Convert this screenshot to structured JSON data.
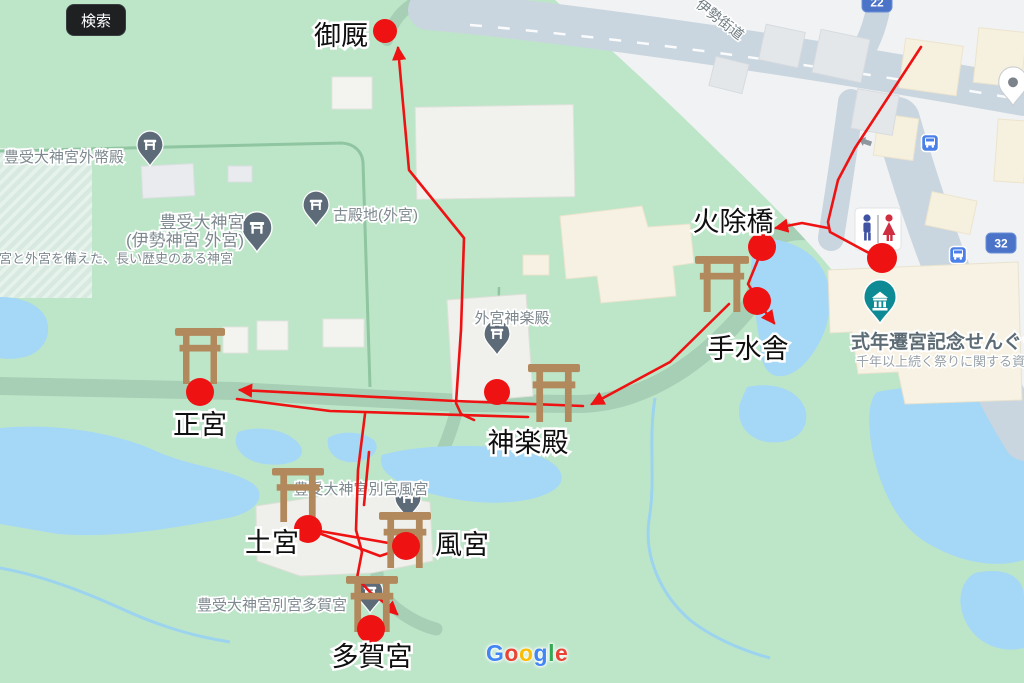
{
  "search_button": {
    "label": "検索"
  },
  "attribution": {
    "brand": "Google",
    "letters": [
      {
        "ch": "G",
        "color": "#4285F4"
      },
      {
        "ch": "o",
        "color": "#EA4335"
      },
      {
        "ch": "o",
        "color": "#FBBC05"
      },
      {
        "ch": "g",
        "color": "#4285F4"
      },
      {
        "ch": "l",
        "color": "#34A853"
      },
      {
        "ch": "e",
        "color": "#EA4335"
      }
    ]
  },
  "colors": {
    "route_red": "#ee1212",
    "torii_brown": "#b2895c",
    "pin_grey": "#5d6b78",
    "museum_teal": "#0d8a93",
    "shield_blue": "#4b74c9",
    "water": "#a5d7f6",
    "park_green": "#bde6c9",
    "road_grey": "#c9d5df"
  },
  "road_shields": [
    {
      "number": "22",
      "x": 877,
      "y": 2
    },
    {
      "number": "32",
      "x": 1001,
      "y": 243
    }
  ],
  "road_names": [
    {
      "text": "伊勢街道",
      "x": 695,
      "y": 6,
      "rotation": 38
    }
  ],
  "poi_labels": [
    {
      "text": "豊受大神宮外幣殿",
      "x": 64,
      "y": 162,
      "cls": ""
    },
    {
      "text": "豊受大神宮",
      "x": 202,
      "y": 228,
      "cls": "big"
    },
    {
      "text": "(伊勢神宮 外宮)",
      "x": 185,
      "y": 246,
      "cls": "big"
    },
    {
      "text": "内宮と外宮を備えた、長い歴史のある神宮",
      "x": -14,
      "y": 263,
      "cls": "small start"
    },
    {
      "text": "古殿地(外宮)",
      "x": 333,
      "y": 220,
      "cls": "start"
    },
    {
      "text": "外宮神楽殿",
      "x": 512,
      "y": 323,
      "cls": ""
    },
    {
      "text": "豊受大神宮別宮風宮",
      "x": 361,
      "y": 494,
      "cls": ""
    },
    {
      "text": "豊受大神宮別宮多賀宮",
      "x": 272,
      "y": 610,
      "cls": ""
    }
  ],
  "museum_label": {
    "title": "式年遷宮記念せんぐう館",
    "title_x": 851,
    "title_y": 348,
    "subtitle": "千年以上続く祭りに関する資",
    "subtitle_x": 856,
    "subtitle_y": 366
  },
  "poi_pins": [
    {
      "type": "shrine",
      "x": 150,
      "y": 152,
      "s": 1
    },
    {
      "type": "shrine",
      "x": 257,
      "y": 236,
      "s": 1.15
    },
    {
      "type": "shrine",
      "x": 316,
      "y": 212,
      "s": 1
    },
    {
      "type": "shrine",
      "x": 497,
      "y": 341,
      "s": 1
    },
    {
      "type": "shrine",
      "x": 408,
      "y": 505,
      "s": 1
    },
    {
      "type": "shrine",
      "x": 370,
      "y": 599,
      "s": 1
    },
    {
      "type": "museum",
      "x": 880,
      "y": 306,
      "s": 1.25
    }
  ],
  "map_icons": {
    "restroom": {
      "x": 878,
      "y": 229
    },
    "generic_pin": {
      "x": 1013,
      "y": 90
    },
    "bus_stops": [
      {
        "x": 930,
        "y": 143
      },
      {
        "x": 958,
        "y": 255
      }
    ]
  },
  "annotations": {
    "dots": [
      {
        "name": "miumaya",
        "x": 385,
        "y": 31,
        "r": 12
      },
      {
        "name": "rest-area",
        "x": 882,
        "y": 258,
        "r": 15
      },
      {
        "name": "hiyokebashi",
        "x": 762,
        "y": 247,
        "r": 14
      },
      {
        "name": "temizusha",
        "x": 757,
        "y": 301,
        "r": 14
      },
      {
        "name": "kaguraden",
        "x": 497,
        "y": 392,
        "r": 13
      },
      {
        "name": "shogu",
        "x": 200,
        "y": 392,
        "r": 14
      },
      {
        "name": "tsuchinomiya",
        "x": 308,
        "y": 529,
        "r": 14
      },
      {
        "name": "kazenomiya",
        "x": 406,
        "y": 546,
        "r": 14
      },
      {
        "name": "takanomiya",
        "x": 371,
        "y": 629,
        "r": 14
      }
    ],
    "labels": [
      {
        "text": "御厩",
        "x": 341,
        "y": 45
      },
      {
        "text": "火除橋",
        "x": 733,
        "y": 231
      },
      {
        "text": "手水舎",
        "x": 748,
        "y": 358
      },
      {
        "text": "正宮",
        "x": 200,
        "y": 434
      },
      {
        "text": "神楽殿",
        "x": 528,
        "y": 452
      },
      {
        "text": "土宮",
        "x": 272,
        "y": 552
      },
      {
        "text": "風宮",
        "x": 462,
        "y": 554
      },
      {
        "text": "多賀宮",
        "x": 372,
        "y": 666
      }
    ],
    "toriis": [
      {
        "x": 722,
        "top": 256,
        "w": 54,
        "h": 56
      },
      {
        "x": 200,
        "top": 328,
        "w": 50,
        "h": 56
      },
      {
        "x": 554,
        "top": 364,
        "w": 52,
        "h": 58
      },
      {
        "x": 298,
        "top": 468,
        "w": 52,
        "h": 54
      },
      {
        "x": 405,
        "top": 512,
        "w": 52,
        "h": 56
      },
      {
        "x": 372,
        "top": 576,
        "w": 52,
        "h": 56
      }
    ],
    "routes": [
      {
        "points": [
          [
            921,
            47
          ],
          [
            855,
            148
          ],
          [
            838,
            180
          ],
          [
            828,
            222
          ],
          [
            830,
            232
          ],
          [
            867,
            252
          ],
          [
            878,
            256
          ]
        ]
      },
      {
        "points": [
          [
            828,
            228
          ],
          [
            802,
            223
          ],
          [
            776,
            228
          ]
        ],
        "arrow_end": true
      },
      {
        "points": [
          [
            762,
            250
          ],
          [
            748,
            284
          ],
          [
            756,
            297
          ]
        ]
      },
      {
        "points": [
          [
            757,
            301
          ],
          [
            774,
            323
          ]
        ],
        "arrow_end": true
      },
      {
        "points": [
          [
            729,
            304
          ],
          [
            670,
            362
          ],
          [
            592,
            404
          ]
        ],
        "arrow_end": true
      },
      {
        "points": [
          [
            583,
            406
          ],
          [
            455,
            401
          ],
          [
            240,
            390
          ]
        ],
        "arrow_end": true
      },
      {
        "points": [
          [
            398,
            48
          ],
          [
            409,
            170
          ],
          [
            464,
            238
          ],
          [
            461,
            330
          ],
          [
            456,
            403
          ],
          [
            461,
            414
          ],
          [
            474,
            420
          ]
        ],
        "arrow_start": true
      },
      {
        "points": [
          [
            237,
            399
          ],
          [
            330,
            411
          ],
          [
            528,
            417
          ]
        ]
      },
      {
        "points": [
          [
            365,
            414
          ],
          [
            358,
            470
          ],
          [
            356,
            530
          ],
          [
            362,
            552
          ],
          [
            357,
            578
          ],
          [
            370,
            592
          ],
          [
            386,
            604
          ],
          [
            397,
            614
          ]
        ],
        "arrow_end": true
      },
      {
        "points": [
          [
            369,
            452
          ],
          [
            364,
            505
          ]
        ]
      },
      {
        "points": [
          [
            308,
            529
          ],
          [
            406,
            546
          ]
        ]
      },
      {
        "points": [
          [
            308,
            529
          ],
          [
            380,
            556
          ],
          [
            404,
            548
          ]
        ]
      }
    ]
  }
}
